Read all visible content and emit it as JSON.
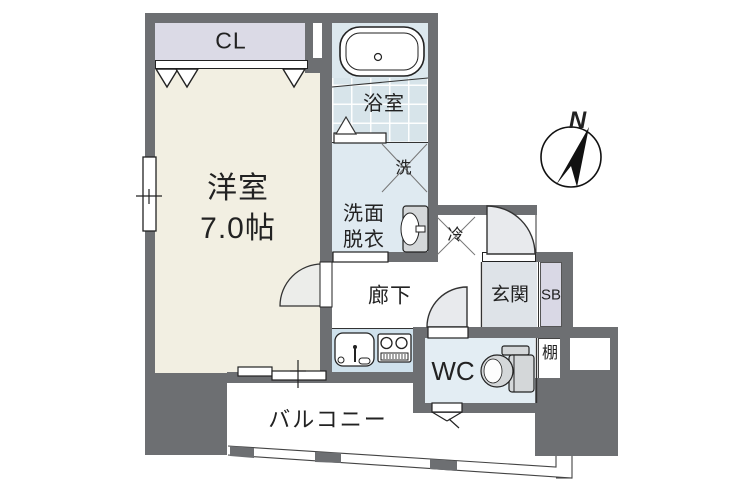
{
  "plan": {
    "compass": {
      "label": "N"
    },
    "rooms": {
      "western_room": {
        "name": "洋室",
        "size": "7.0帖"
      },
      "closet": {
        "label": "CL"
      },
      "bathroom": {
        "label": "浴室"
      },
      "washroom": {
        "line1": "洗面",
        "line2": "脱衣"
      },
      "washer": {
        "label": "洗"
      },
      "fridge": {
        "label": "冷"
      },
      "hallway": {
        "label": "廊下"
      },
      "entrance": {
        "label": "玄関"
      },
      "shoe_box": {
        "label": "SB"
      },
      "wc": {
        "label": "WC"
      },
      "shelf": {
        "label": "棚"
      },
      "balcony": {
        "label": "バルコニー"
      }
    },
    "colors": {
      "wall": "#6d6f72",
      "western_room_fill": "#f2efe2",
      "closet_fill": "#dbdae6",
      "shoebox_fill": "#d9d8e5",
      "bathroom_fill": "#dce8ee",
      "bathroom_tile": "#d7e4ea",
      "washroom_fill": "#dfeaf1",
      "kitchen_fill": "#cfe1ec",
      "wc_fill": "#e3edf3",
      "entrance_fill": "#dee3e8",
      "appliance_fill": "#d6d6d6",
      "door_arc_fill": "#e8eaed"
    }
  }
}
